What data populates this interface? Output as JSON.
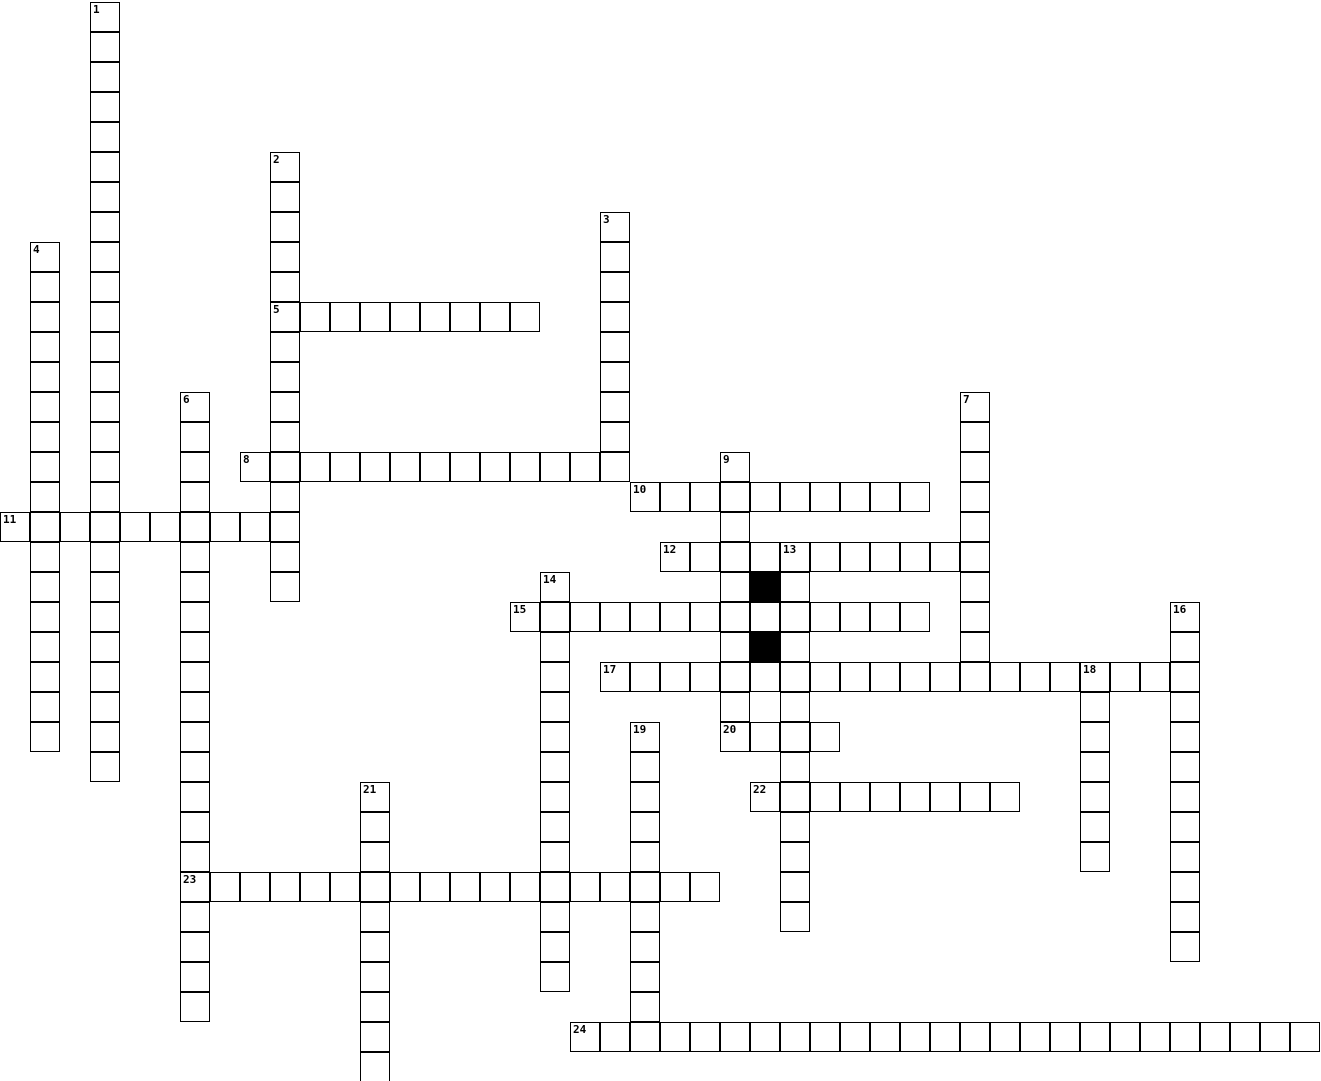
{
  "puzzle": {
    "type": "crossword",
    "cell_size": 30,
    "origin_x": 0,
    "origin_y": 2,
    "grid_line_color": "#000000",
    "cell_fill_color": "#ffffff",
    "block_fill_color": "#000000",
    "background_color": "#ffffff",
    "number_labels": [
      "1",
      "2",
      "3",
      "4",
      "5",
      "6",
      "7",
      "8",
      "9",
      "10",
      "11",
      "12",
      "13",
      "14",
      "15",
      "16",
      "17",
      "18",
      "19",
      "20",
      "21",
      "22",
      "23",
      "24"
    ],
    "entries": [
      {
        "number": "1",
        "col": 3,
        "row": 0,
        "dir": "down",
        "length": 26
      },
      {
        "number": "2",
        "col": 9,
        "row": 5,
        "dir": "down",
        "length": 15
      },
      {
        "number": "3",
        "col": 20,
        "row": 7,
        "dir": "down",
        "length": 9
      },
      {
        "number": "4",
        "col": 1,
        "row": 8,
        "dir": "down",
        "length": 17
      },
      {
        "number": "5",
        "col": 9,
        "row": 10,
        "dir": "across",
        "length": 9
      },
      {
        "number": "6",
        "col": 6,
        "row": 13,
        "dir": "down",
        "length": 21
      },
      {
        "number": "7",
        "col": 32,
        "row": 13,
        "dir": "down",
        "length": 10
      },
      {
        "number": "8",
        "col": 8,
        "row": 15,
        "dir": "across",
        "length": 13
      },
      {
        "number": "9",
        "col": 24,
        "row": 15,
        "dir": "down",
        "length": 10
      },
      {
        "number": "10",
        "col": 21,
        "row": 16,
        "dir": "across",
        "length": 10
      },
      {
        "number": "11",
        "col": 0,
        "row": 17,
        "dir": "across",
        "length": 10
      },
      {
        "number": "12",
        "col": 22,
        "row": 18,
        "dir": "across",
        "length": 11
      },
      {
        "number": "13",
        "col": 26,
        "row": 18,
        "dir": "down",
        "length": 13
      },
      {
        "number": "14",
        "col": 18,
        "row": 19,
        "dir": "down",
        "length": 14
      },
      {
        "number": "15",
        "col": 17,
        "row": 20,
        "dir": "across",
        "length": 14
      },
      {
        "number": "16",
        "col": 39,
        "row": 20,
        "dir": "down",
        "length": 12
      },
      {
        "number": "17",
        "col": 20,
        "row": 22,
        "dir": "across",
        "length": 20
      },
      {
        "number": "18",
        "col": 36,
        "row": 22,
        "dir": "down",
        "length": 7
      },
      {
        "number": "19",
        "col": 21,
        "row": 24,
        "dir": "down",
        "length": 11
      },
      {
        "number": "20",
        "col": 24,
        "row": 24,
        "dir": "across",
        "length": 4
      },
      {
        "number": "21",
        "col": 12,
        "row": 26,
        "dir": "down",
        "length": 10
      },
      {
        "number": "22",
        "col": 25,
        "row": 26,
        "dir": "across",
        "length": 9
      },
      {
        "number": "23",
        "col": 6,
        "row": 29,
        "dir": "across",
        "length": 18
      },
      {
        "number": "24",
        "col": 19,
        "row": 34,
        "dir": "across",
        "length": 25
      }
    ],
    "black_cells": [
      {
        "col": 25,
        "row": 19
      },
      {
        "col": 25,
        "row": 21
      }
    ]
  }
}
